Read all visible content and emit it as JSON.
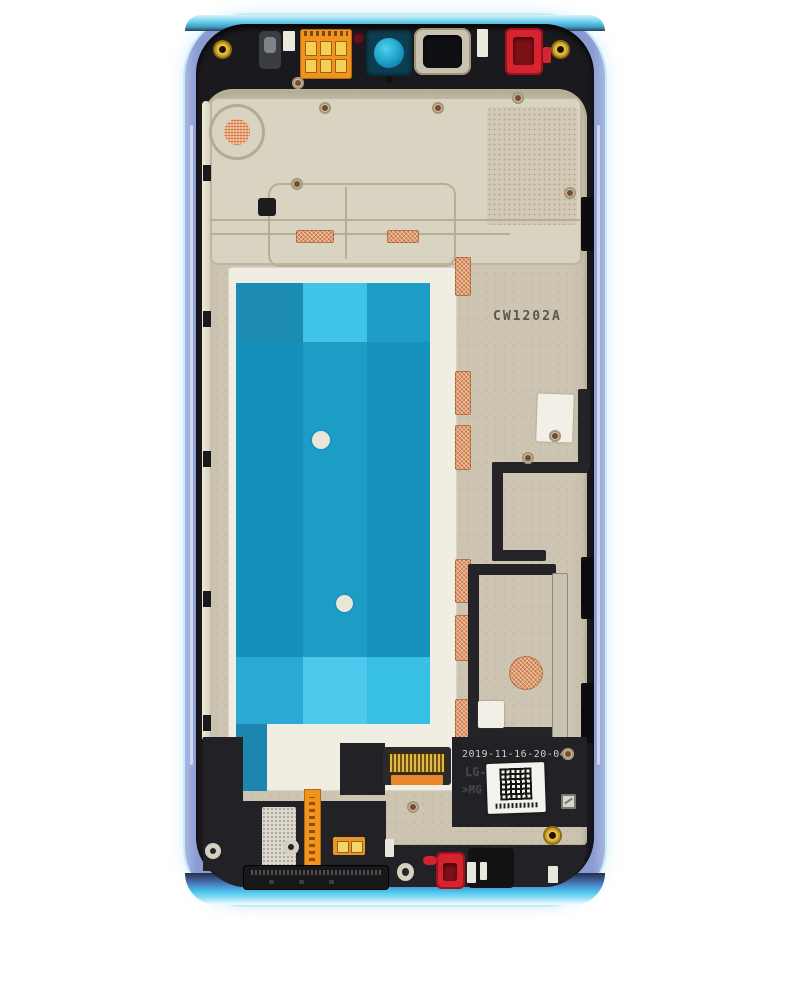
{
  "image": {
    "type": "product-photo",
    "subject": "Smartphone mid-frame with LCD assembly, rear view, blue frame replacement part",
    "background_color": "#ffffff"
  },
  "markings": {
    "plate_stamp": "CW1202A",
    "date_code": "2019-11-16-20-04",
    "model_emboss": "LG-MH4+",
    "emboss_fragment": ">MG      2-2"
  },
  "colors": {
    "frame_side_blue": "#8b9cd3",
    "frame_top_edge_cyan": "#6fd2ee",
    "frame_bottom_edge_cyan": "#49c4ec",
    "chassis_black": "#1a1a1e",
    "plate_beige": "#cdc5b2",
    "plate_light_beige": "#d9d3c2",
    "lcd_backplate_white": "#f0ede3",
    "tape_teal": "#1590ba",
    "tape_light_cyan": "#4cc9ec",
    "copper_coil": "#e09a6c",
    "flex_cable_orange": "#f0941e",
    "gold_contact": "#f5cf58",
    "gasket_red": "#d62330",
    "camera_lens_cyan": "#2ab9dc",
    "screw_gold": "#e8c23e"
  }
}
